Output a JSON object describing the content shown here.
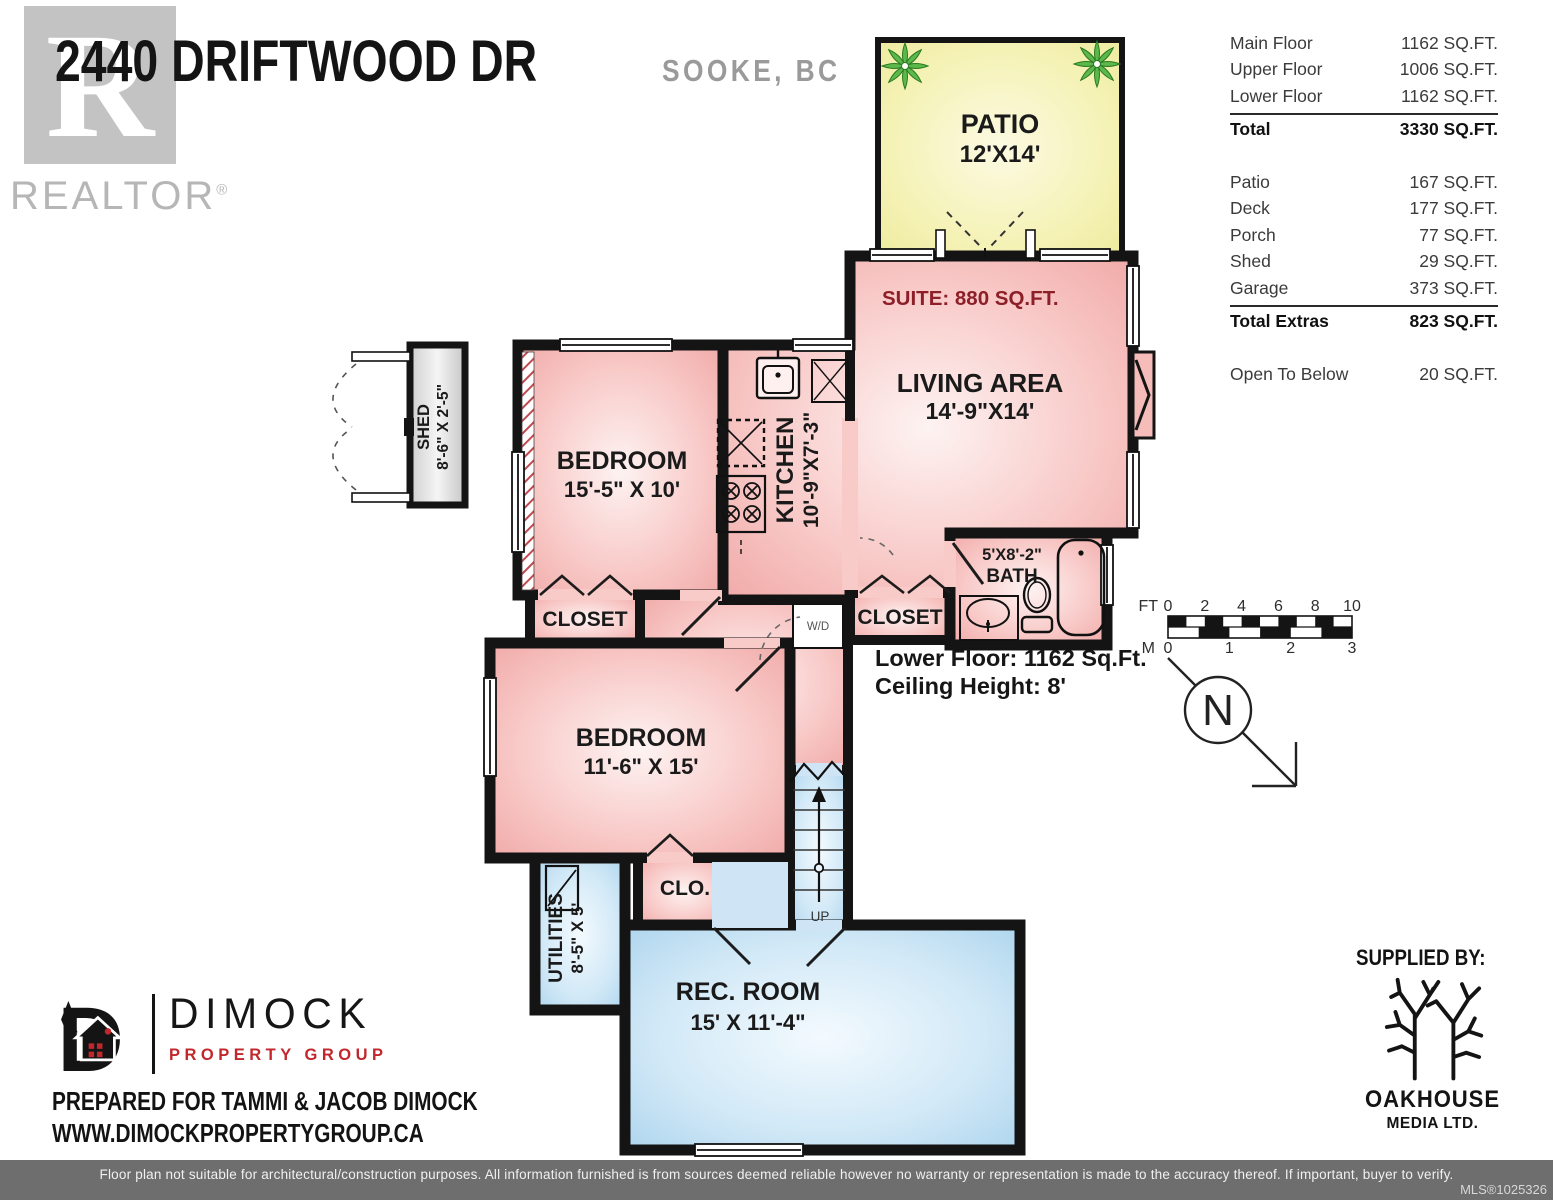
{
  "header": {
    "address": "2440 DRIFTWOOD DR",
    "city": "SOOKE, BC",
    "realtor_r": "R",
    "realtor_word": "REALTOR",
    "realtor_reg": "®"
  },
  "area_table": {
    "floors": [
      {
        "label": "Main Floor",
        "value": "1162 SQ.FT."
      },
      {
        "label": "Upper Floor",
        "value": "1006 SQ.FT."
      },
      {
        "label": "Lower Floor",
        "value": "1162 SQ.FT."
      }
    ],
    "total": {
      "label": "Total",
      "value": "3330 SQ.FT."
    },
    "extras": [
      {
        "label": "Patio",
        "value": "167 SQ.FT."
      },
      {
        "label": "Deck",
        "value": "177 SQ.FT."
      },
      {
        "label": "Porch",
        "value": "77 SQ.FT."
      },
      {
        "label": "Shed",
        "value": "29 SQ.FT."
      },
      {
        "label": "Garage",
        "value": "373 SQ.FT."
      }
    ],
    "total_extras": {
      "label": "Total Extras",
      "value": "823 SQ.FT."
    },
    "open_to_below": {
      "label": "Open To Below",
      "value": "20 SQ.FT."
    }
  },
  "floorplan": {
    "suite_note": "SUITE: 880 SQ.FT.",
    "notes": {
      "lower_floor": "Lower Floor: 1162 Sq.Ft.",
      "ceiling": "Ceiling Height: 8'"
    },
    "rooms": {
      "patio": {
        "name": "PATIO",
        "dims": "12'X14'"
      },
      "living": {
        "name": "LIVING AREA",
        "dims": "14'-9\"X14'"
      },
      "bedroom1": {
        "name": "BEDROOM",
        "dims": "15'-5\" X 10'"
      },
      "kitchen": {
        "name": "KITCHEN",
        "dims": "10'-9\"X7'-3\""
      },
      "closet1": {
        "name": "CLOSET"
      },
      "closet2": {
        "name": "CLOSET"
      },
      "bath": {
        "name": "BATH",
        "dims": "5'X8'-2\""
      },
      "bedroom2": {
        "name": "BEDROOM",
        "dims": "11'-6\" X 15'"
      },
      "clo": {
        "name": "CLO."
      },
      "utilities": {
        "name": "UTILITIES",
        "dims": "8'-5\" X 5'"
      },
      "recroom": {
        "name": "REC. ROOM",
        "dims": "15' X 11'-4\""
      },
      "shed": {
        "name": "SHED",
        "dims": "8'-6\" X 2'-5\""
      },
      "wd": "W/D",
      "up": "UP"
    },
    "scale": {
      "ft_label": "FT",
      "ft_ticks": [
        "0",
        "2",
        "4",
        "6",
        "8",
        "10"
      ],
      "m_label": "M",
      "m_ticks": [
        "0",
        "1",
        "2",
        "3"
      ]
    },
    "north": "N",
    "colors": {
      "wall": "#141414",
      "pink_edge": "#efa5a3",
      "blue_edge": "#a9d2ec",
      "yellow_edge": "#ecea9b",
      "suite_text": "#8c1f28",
      "plant_green": "#4fae3d"
    }
  },
  "branding": {
    "dimock": {
      "name": "DIMOCK",
      "sub": "PROPERTY GROUP",
      "prepared": "PREPARED FOR TAMMI & JACOB DIMOCK",
      "website": "WWW.DIMOCKPROPERTYGROUP.CA"
    },
    "supplied_by": "SUPPLIED BY:",
    "oakhouse": {
      "name": "OAKHOUSE",
      "sub": "MEDIA LTD."
    }
  },
  "footer": {
    "disclaimer": "Floor plan not suitable for architectural/construction purposes. All information furnished is from sources deemed reliable however no warranty or representation is made to the accuracy thereof. If important, buyer to verify.",
    "mls": "MLS®1025326"
  }
}
